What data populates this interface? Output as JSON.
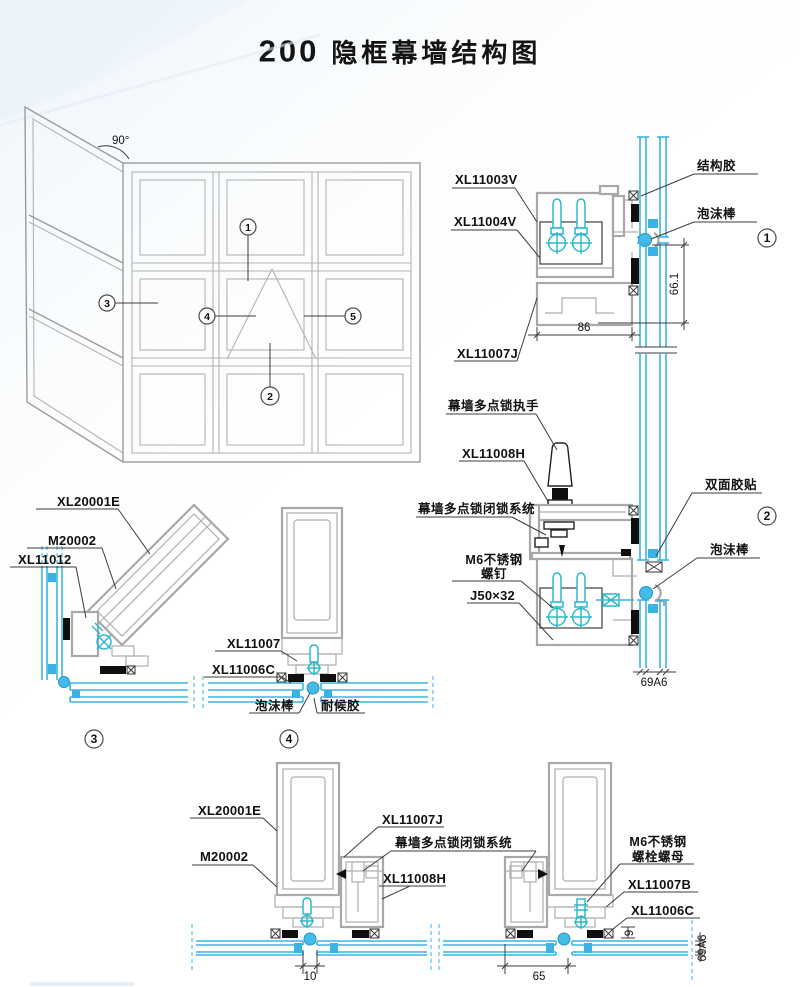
{
  "title": {
    "number": "200",
    "text": "隐框幕墙结构图"
  },
  "colors": {
    "glass": "#3ab3e4",
    "profile": "#a8a8a8",
    "hardware": "#2eb9cc",
    "gasket": "#0f0f0f"
  },
  "elevation": {
    "angle_label": "90°",
    "marker_1": "1",
    "marker_2": "2",
    "marker_3": "3",
    "marker_4": "4",
    "marker_5": "5"
  },
  "detail_1": {
    "marker": "1",
    "label_xl11003v": "XL11003V",
    "label_xl11004v": "XL11004V",
    "label_xl11007j": "XL11007J",
    "label_structural_sealant": "结构胶",
    "label_foam_rod": "泡沫棒",
    "dim_width": "86",
    "dim_height": "66.1"
  },
  "detail_2": {
    "marker": "2",
    "label_handle": "幕墙多点锁执手",
    "label_xl11008h": "XL11008H",
    "label_lock_system": "幕墙多点锁闭锁系统",
    "label_m6_line1": "M6不锈钢",
    "label_m6_line2": "螺钉",
    "label_j50": "J50×32",
    "label_double_tape": "双面胶贴",
    "label_foam_rod": "泡沫棒",
    "dim_glass": "69A6"
  },
  "detail_3": {
    "marker": "3",
    "label_xl20001e": "XL20001E",
    "label_m20002": "M20002",
    "label_xl11012": "XL11012"
  },
  "detail_4": {
    "marker": "4",
    "label_xl11007": "XL11007",
    "label_xl11006c": "XL11006C",
    "label_foam_rod": "泡沫棒",
    "label_weather_sealant": "耐候胶"
  },
  "detail_5": {
    "label_xl20001e": "XL20001E",
    "label_m20002": "M20002",
    "label_xl11007j": "XL11007J",
    "label_lock_system": "幕墙多点锁闭锁系统",
    "label_xl11008h": "XL11008H",
    "label_m6_line1": "M6不锈钢",
    "label_m6_line2": "螺栓螺母",
    "label_xl11007b": "XL11007B",
    "label_xl11006c": "XL11006C",
    "dim_gap": "10",
    "dim_width": "65",
    "dim_nine": "9",
    "dim_glass": "69A6"
  }
}
